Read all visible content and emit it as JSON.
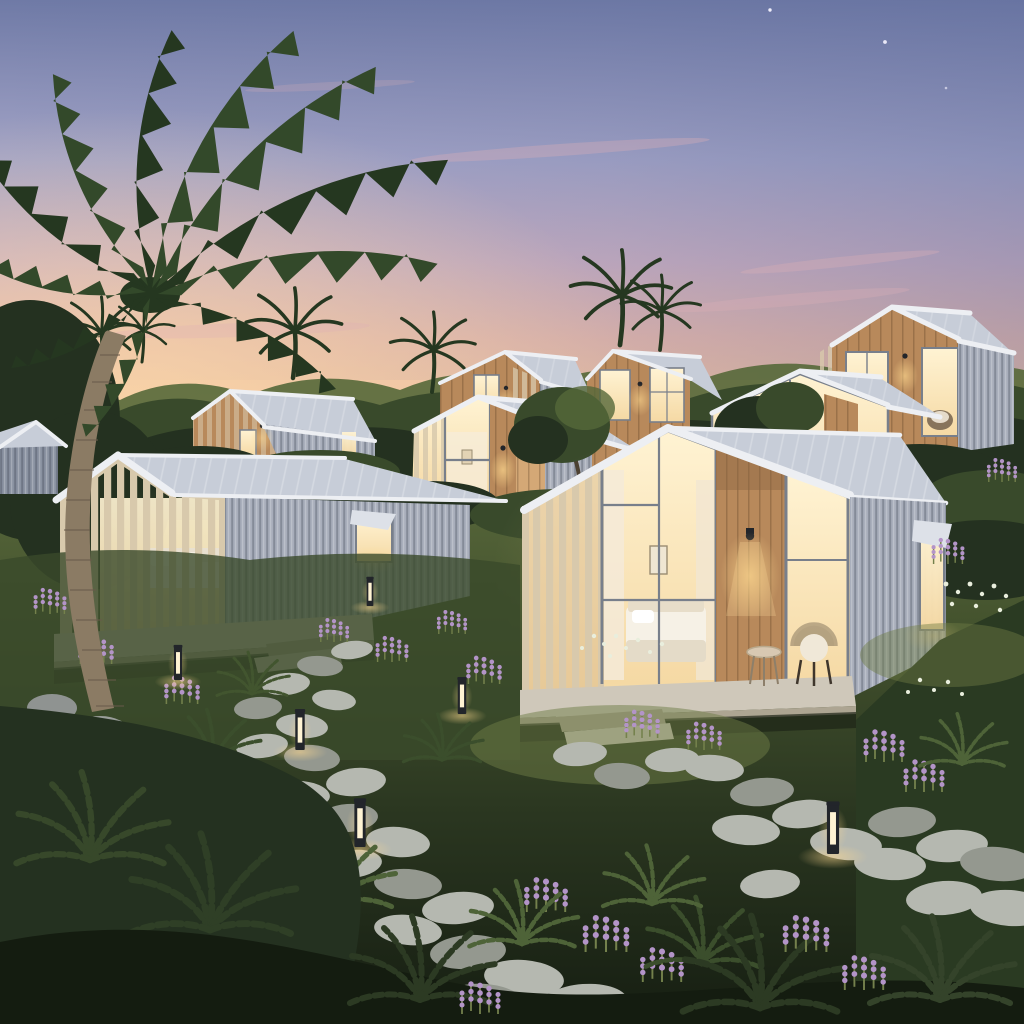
{
  "scene": {
    "type": "photorealistic 3D architectural rendering",
    "time_of_day": "dusk",
    "setting": "tropical hillside garden village of prefab tiny-house cabins",
    "description": "Dusk rendering of a tiny-house cabin village on a lush tropical hillside: gabled prefab cabins with corrugated metal siding, timber slat screens and warmly lit glass walls, a large coconut palm, winding stone stepping path, bollard path lights, ferns and lavender",
    "sky": {
      "stars_visible": 3,
      "clouds": "wispy pink streaks",
      "sunset_side": "left"
    },
    "cabins": {
      "count_visible": 9,
      "style": "gabled prefab cabins, corrugated metal siding, timber slat screens, full-height glazing, warm interior light",
      "foreground_left": "cabin with slatted pergola porch, sofa inside, side awning window, concrete deck and steps",
      "foreground_main": "cabin with bedroom behind glass wall, timber feature column with sconce, porch with wicker chair and round side table, concrete steps, open awning window on side",
      "wall_sconce_count": 7
    },
    "landscape": {
      "large_palm_count": 1,
      "horizon_palm_count": 6,
      "bollard_light_count": 6,
      "path": "winding stone stepping-stone path",
      "plants": [
        "ferns",
        "lavender",
        "white wildflowers",
        "grasses",
        "shrubs"
      ],
      "boulders": 3
    }
  },
  "palette": {
    "sky_top": "#6f7aa6",
    "sky_mid": "#a2a3c6",
    "sky_mauve": "#c9aec0",
    "sky_pink": "#e5b7ab",
    "sky_horizon": "#f2c4a0",
    "sunset_glow": "#fad7a8",
    "cloud_pink": "#ddb0b6",
    "star": "#f7f4ff",
    "roof_mid": "#c7cdd8",
    "roof_light": "#dde1e8",
    "roof_fascia": "#edeff3",
    "siding_mid": "#a8aebb",
    "siding_dark": "#8a92a1",
    "frame": "#787f8b",
    "wood_light": "#d4a876",
    "wood_mid": "#b8895b",
    "wood_dark": "#8c6543",
    "slat_wood": "#d8c9ac",
    "window_bright": "#fff3d3",
    "window_glow": "#f5d9a4",
    "light_glow": "#ffd98f",
    "fixture": "#22252a",
    "concrete": "#cfc8ba",
    "concrete_shade": "#ada592",
    "stone": "#b5b8b0",
    "stone_shade": "#94988f",
    "grass_lit": "#6e7c45",
    "foliage_light": "#55683a",
    "foliage_mid": "#394a2b",
    "foliage_dark": "#243120",
    "ground_dark": "#141c10",
    "fern_green": "#4e6338",
    "palm_green": "#33492a",
    "palm_dark": "#253720",
    "trunk": "#8b7b64",
    "trunk_shadow": "#67594a",
    "flower_purple": "#b394c8",
    "flower_white": "#e9eedd"
  }
}
